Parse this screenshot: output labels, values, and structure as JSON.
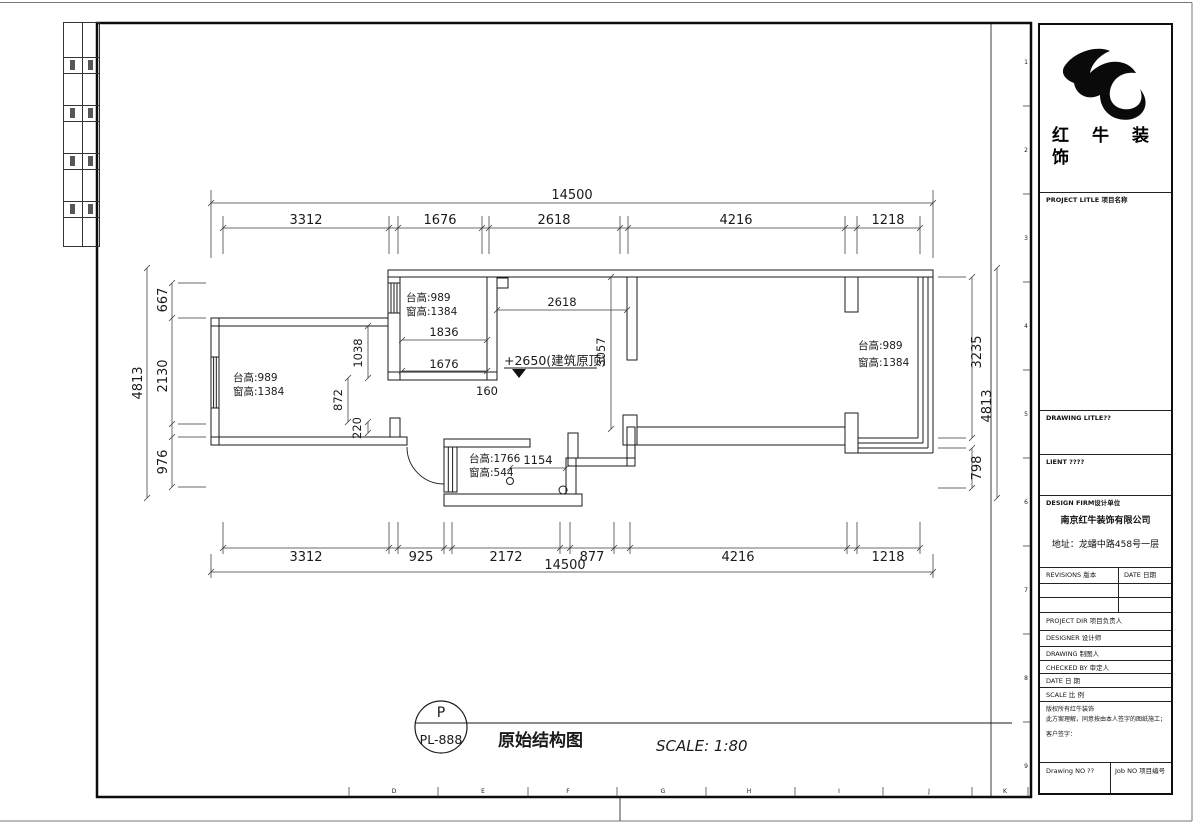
{
  "sheet": {
    "col_letters": [
      "D",
      "E",
      "F",
      "G",
      "H",
      "I",
      "J",
      "K"
    ],
    "row_numbers": [
      "1",
      "2",
      "3",
      "4",
      "5",
      "6",
      "7",
      "8",
      "9"
    ]
  },
  "plan": {
    "top_overall": "14500",
    "top_segments": [
      "3312",
      "1676",
      "2618",
      "4216",
      "1218"
    ],
    "bottom_segments": [
      "3312",
      "925",
      "2172",
      "877",
      "4216",
      "1218"
    ],
    "bottom_overall": "14500",
    "left_segments": [
      "667",
      "2130",
      "976"
    ],
    "left_overall": "4813",
    "right_segments": [
      "3235",
      "798"
    ],
    "right_overall": "4813",
    "interior_dims": {
      "d1836": "1836",
      "d1676": "1676",
      "d160": "160",
      "d2618": "2618",
      "d3057": "3057",
      "d1038": "1038",
      "d872": "872",
      "d220": "220",
      "d1154": "1154"
    },
    "ceiling_note": "+2650(建筑原顶)",
    "rooms": {
      "left": {
        "line1": "台高:989",
        "line2": "窗高:1384"
      },
      "middle": {
        "line1": "台高:989",
        "line2": "窗高:1384"
      },
      "right": {
        "line1": "台高:989",
        "line2": "窗高:1384"
      },
      "bath": {
        "line1": "台高:1766",
        "line2": "窗高:544"
      }
    }
  },
  "footer": {
    "tag_letter": "P",
    "tag_number": "PL-888",
    "drawing_name": "原始结构图",
    "scale_text": "SCALE: 1:80"
  },
  "title_block": {
    "company_name": "红牛装饰",
    "project_title_label": "PROJECT LITLE 项目名称",
    "drawing_title_label": "DRAWING LITLE??",
    "client_label": "LIENT ????",
    "design_firm_label": "DESIGN FIRM设计单位",
    "firm_name": "南京红牛装饰有限公司",
    "firm_address": "地址：龙蟠中路458号一层",
    "revisions_label": "REVISIONS 版本",
    "revisions_date_label": "DATE 日期",
    "project_dir_label": "PROJECT DIR 项目负责人",
    "designer_label": "DESIGNER 设计师",
    "drawing_by_label": "DRAWING 制图人",
    "checked_by_label": "CHECKED BY 审定人",
    "date_label": "DATE 日 期",
    "scale_label": "SCALE 比 例",
    "copyright_note_1": "版权所有红牛装饰",
    "copyright_note_2": "此方案理解，同意按由本人签字的图纸施工；",
    "copyright_note_3": "客户签字：",
    "drawing_no_label": "Drawing NO ??",
    "job_no_label": "Job NO 项目编号"
  }
}
